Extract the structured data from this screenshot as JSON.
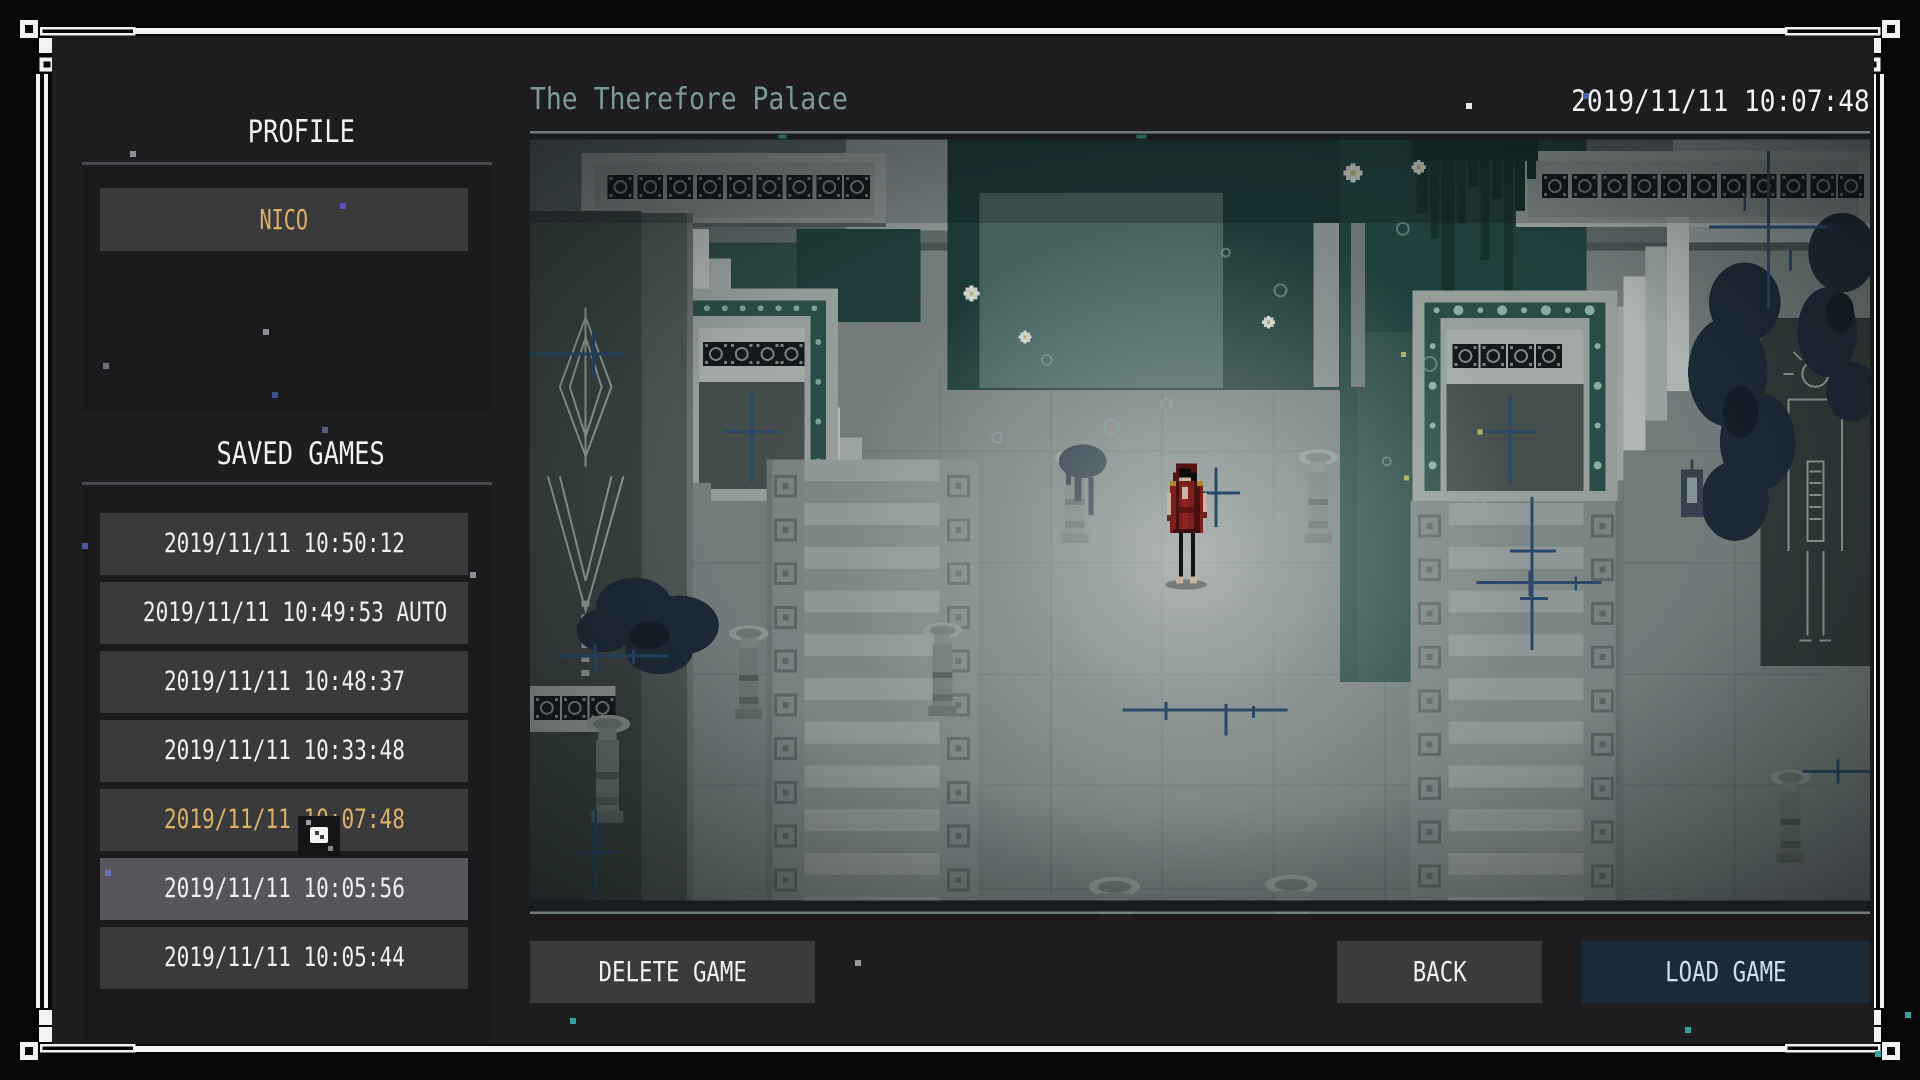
{
  "sidebar": {
    "profile_heading": "PROFILE",
    "profile_name": "NICO",
    "saved_games_heading": "SAVED GAMES",
    "saves": [
      {
        "label": "2019/11/11 10:50:12",
        "state": "normal"
      },
      {
        "label": "2019/11/11 10:49:53 AUTO",
        "state": "normal"
      },
      {
        "label": "2019/11/11 10:48:37",
        "state": "normal"
      },
      {
        "label": "2019/11/11 10:33:48",
        "state": "normal"
      },
      {
        "label": "2019/11/11 10:07:48",
        "state": "selected"
      },
      {
        "label": "2019/11/11 10:05:56",
        "state": "hovered"
      },
      {
        "label": "2019/11/11 10:05:44",
        "state": "normal"
      }
    ]
  },
  "main": {
    "map_title": "The Therefore Palace",
    "save_timestamp": "2019/11/11 10:07:48",
    "preview_description": "pixel-art palace courtyard with hooded figure in red",
    "buttons": {
      "delete": "DELETE GAME",
      "back": "BACK",
      "load": "LOAD GAME"
    }
  },
  "icons": {
    "cursor": "pixel-cursor",
    "frame": "white-corner-frame-ornament"
  },
  "colors": {
    "accent_gold": "#ddb269",
    "title_teal": "#7f989b",
    "load_button_bg": "#1a2a38",
    "load_button_text": "#cfe0ec",
    "panel_bg": "#1d1d1f",
    "item_bg": "#3a393c",
    "item_hover_bg": "#57555b",
    "frame_white": "#f2f2f2"
  }
}
